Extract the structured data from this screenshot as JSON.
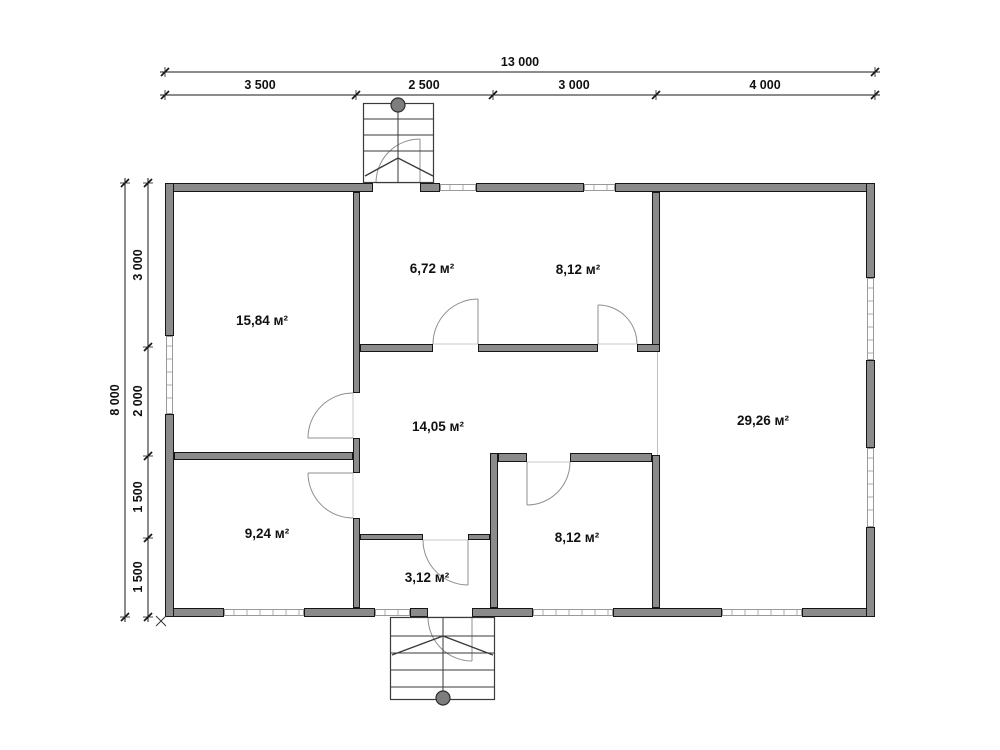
{
  "page": {
    "background": "#ffffff"
  },
  "plan": {
    "colors": {
      "wall_fill": "#8b8b8b",
      "wall_edge": "#161616",
      "window_line": "#9a9a9a",
      "door_line": "#8f8f8f",
      "threshold_line": "#c9c9c9",
      "stair_line": "#3a3a3a",
      "passage_line": "#c0c0c0",
      "dim_line": "#1a1a1a",
      "text": "#111111"
    },
    "walls": [
      [
        165,
        183,
        208,
        9
      ],
      [
        420,
        183,
        20,
        9
      ],
      [
        476,
        183,
        108,
        9
      ],
      [
        615,
        183,
        260,
        9
      ],
      [
        165,
        608,
        59,
        9
      ],
      [
        304,
        608,
        71,
        9
      ],
      [
        410,
        608,
        18,
        9
      ],
      [
        472,
        608,
        61,
        9
      ],
      [
        613,
        608,
        109,
        9
      ],
      [
        802,
        608,
        73,
        9
      ],
      [
        165,
        183,
        9,
        153
      ],
      [
        165,
        414,
        9,
        203
      ],
      [
        866,
        183,
        9,
        95
      ],
      [
        866,
        360,
        9,
        88
      ],
      [
        866,
        527,
        9,
        90
      ],
      [
        353,
        192,
        7,
        201
      ],
      [
        353,
        438,
        7,
        35
      ],
      [
        353,
        518,
        7,
        90
      ],
      [
        490,
        453,
        8,
        155
      ],
      [
        652,
        192,
        8,
        160
      ],
      [
        652,
        455,
        8,
        153
      ],
      [
        360,
        344,
        73,
        8
      ],
      [
        478,
        344,
        120,
        8
      ],
      [
        637,
        344,
        23,
        8
      ],
      [
        174,
        452,
        179,
        8
      ],
      [
        498,
        453,
        29,
        9
      ],
      [
        570,
        453,
        82,
        9
      ],
      [
        360,
        534,
        63,
        6
      ],
      [
        468,
        534,
        22,
        6
      ]
    ],
    "windows": [
      {
        "x": 440,
        "y": 184,
        "w": 36,
        "h": 7
      },
      {
        "x": 584,
        "y": 184,
        "w": 31,
        "h": 7
      },
      {
        "x": 224,
        "y": 609,
        "w": 80,
        "h": 7
      },
      {
        "x": 375,
        "y": 609,
        "w": 35,
        "h": 7
      },
      {
        "x": 533,
        "y": 609,
        "w": 80,
        "h": 7
      },
      {
        "x": 722,
        "y": 609,
        "w": 80,
        "h": 7
      },
      {
        "x": 166,
        "y": 336,
        "w": 7,
        "h": 78
      },
      {
        "x": 867,
        "y": 278,
        "w": 7,
        "h": 82
      },
      {
        "x": 867,
        "y": 448,
        "w": 7,
        "h": 79
      }
    ],
    "passage_lines": [
      [
        657.5,
        352,
        657.5,
        455
      ]
    ],
    "doors": [
      {
        "name": "door-entry-top",
        "jamb": [
          376,
          183
        ],
        "hinge": [
          420,
          183
        ],
        "open": [
          420,
          139
        ],
        "r": 44,
        "sweep": 1
      },
      {
        "name": "door-room-672",
        "jamb": [
          433,
          344
        ],
        "hinge": [
          478,
          344
        ],
        "open": [
          478,
          299
        ],
        "r": 45,
        "sweep": 1
      },
      {
        "name": "door-room-812-top",
        "jamb": [
          637,
          344
        ],
        "hinge": [
          598,
          344
        ],
        "open": [
          598,
          305
        ],
        "r": 39,
        "sweep": 0
      },
      {
        "name": "door-room-1584",
        "jamb": [
          353,
          393
        ],
        "hinge": [
          353,
          438
        ],
        "open": [
          308,
          438
        ],
        "r": 45,
        "sweep": 0
      },
      {
        "name": "door-room-924",
        "jamb": [
          353,
          518
        ],
        "hinge": [
          353,
          473
        ],
        "open": [
          308,
          473
        ],
        "r": 45,
        "sweep": 1
      },
      {
        "name": "door-room-312",
        "jamb": [
          423,
          540
        ],
        "hinge": [
          468,
          540
        ],
        "open": [
          468,
          585
        ],
        "r": 45,
        "sweep": 0
      },
      {
        "name": "door-room-812-bottom",
        "jamb": [
          570,
          462
        ],
        "hinge": [
          527,
          462
        ],
        "open": [
          527,
          505
        ],
        "r": 43,
        "sweep": 1
      },
      {
        "name": "door-entry-bottom",
        "jamb": [
          428,
          617
        ],
        "hinge": [
          472,
          617
        ],
        "open": [
          472,
          661
        ],
        "r": 44,
        "sweep": 0
      }
    ],
    "stairs": [
      {
        "name": "stair-top",
        "x": 363,
        "y": 103,
        "w": 71,
        "h": 80,
        "treads": [
          119,
          135,
          151
        ],
        "axis": [
          398,
          103,
          398,
          183
        ],
        "circle": [
          398,
          105,
          7
        ],
        "chevron": [
          [
            365,
            176
          ],
          [
            398,
            158
          ],
          [
            433,
            176
          ]
        ]
      },
      {
        "name": "stair-bottom",
        "x": 390,
        "y": 617,
        "w": 105,
        "h": 83,
        "treads": [
          636,
          653,
          670,
          687
        ],
        "axis": [
          443,
          617,
          443,
          700
        ],
        "circle": [
          443,
          698,
          7
        ],
        "chevron": [
          [
            392,
            655
          ],
          [
            443,
            636
          ],
          [
            493,
            655
          ]
        ]
      }
    ],
    "room_labels": [
      {
        "name": "room-label-15-84",
        "text": "15,84 м²",
        "x": 262,
        "y": 325
      },
      {
        "name": "room-label-6-72",
        "text": "6,72 м²",
        "x": 432,
        "y": 273
      },
      {
        "name": "room-label-8-12-top",
        "text": "8,12 м²",
        "x": 578,
        "y": 274
      },
      {
        "name": "room-label-29-26",
        "text": "29,26 м²",
        "x": 763,
        "y": 425
      },
      {
        "name": "room-label-14-05",
        "text": "14,05 м²",
        "x": 438,
        "y": 431
      },
      {
        "name": "room-label-9-24",
        "text": "9,24 м²",
        "x": 267,
        "y": 538
      },
      {
        "name": "room-label-3-12",
        "text": "3,12 м²",
        "x": 427,
        "y": 582
      },
      {
        "name": "room-label-8-12-bottom",
        "text": "8,12 м²",
        "x": 577,
        "y": 542
      }
    ],
    "dim_lines": [
      {
        "o": "h",
        "pos": 72,
        "from": 165,
        "to": 875,
        "ticks": [
          165,
          875
        ],
        "labels": [
          {
            "t": "13 000",
            "at": 520
          }
        ]
      },
      {
        "o": "h",
        "pos": 95,
        "from": 165,
        "to": 875,
        "ticks": [
          165,
          356,
          493,
          656,
          875
        ],
        "labels": [
          {
            "t": "3 500",
            "at": 260
          },
          {
            "t": "2 500",
            "at": 424
          },
          {
            "t": "3 000",
            "at": 574
          },
          {
            "t": "4 000",
            "at": 765
          }
        ]
      },
      {
        "o": "v",
        "pos": 125,
        "from": 183,
        "to": 617,
        "ticks": [
          183,
          617
        ],
        "labels": [
          {
            "t": "8 000",
            "at": 400
          }
        ]
      },
      {
        "o": "v",
        "pos": 148,
        "from": 183,
        "to": 617,
        "ticks": [
          183,
          347,
          456,
          538,
          617
        ],
        "labels": [
          {
            "t": "3 000",
            "at": 265
          },
          {
            "t": "2 000",
            "at": 401
          },
          {
            "t": "1 500",
            "at": 497
          },
          {
            "t": "1 500",
            "at": 577
          }
        ]
      }
    ],
    "markers": [
      {
        "type": "cross",
        "x": 161,
        "y": 621,
        "r": 5
      }
    ]
  }
}
